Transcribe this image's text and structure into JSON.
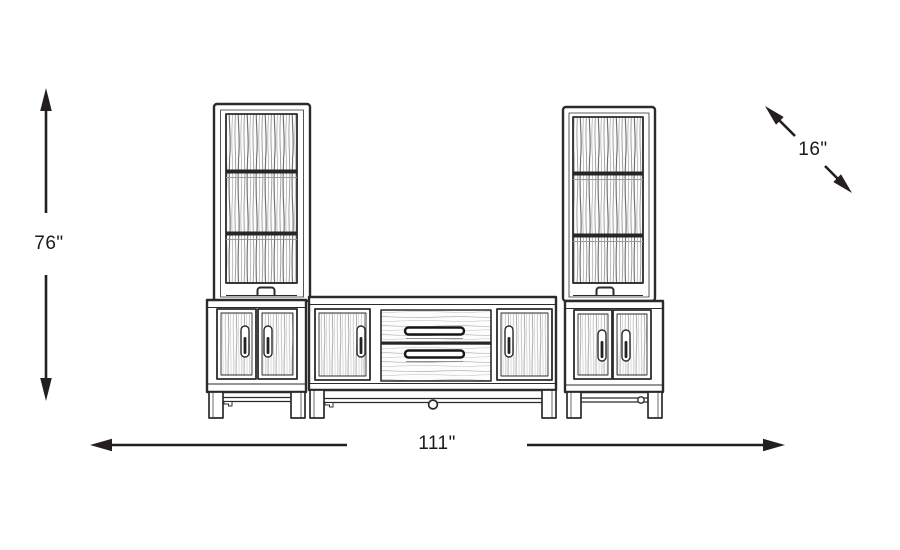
{
  "page": {
    "background": "#ffffff",
    "line_color": "#231f20",
    "text_color": "#1a1a1a"
  },
  "diagram": {
    "type": "furniture-dimension-diagram",
    "subject": "wall-unit-entertainment-center-line-drawing",
    "dimensions": {
      "height": {
        "label": "76\"",
        "orientation": "vertical",
        "position": "left"
      },
      "depth": {
        "label": "16\"",
        "orientation": "diagonal",
        "position": "top-right"
      },
      "width": {
        "label": "111\"",
        "orientation": "horizontal",
        "position": "bottom"
      }
    }
  }
}
